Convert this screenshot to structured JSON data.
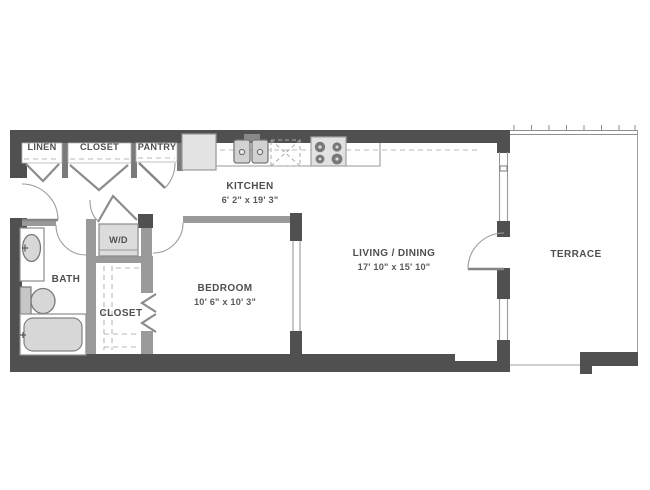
{
  "plan": {
    "type": "apartment-floor-plan",
    "rooms": {
      "linen": {
        "label": "LINEN"
      },
      "closet_hall": {
        "label": "CLOSET"
      },
      "pantry": {
        "label": "PANTRY"
      },
      "kitchen": {
        "label": "KITCHEN",
        "dimensions": "6' 2\" x 19' 3\""
      },
      "washer_dryer": {
        "label": "W/D"
      },
      "bath": {
        "label": "BATH"
      },
      "closet_bedroom": {
        "label": "CLOSET"
      },
      "bedroom": {
        "label": "BEDROOM",
        "dimensions": "10' 6\" x 10' 3\""
      },
      "living_dining": {
        "label": "LIVING / DINING",
        "dimensions": "17' 10\" x 15' 10\""
      },
      "terrace": {
        "label": "TERRACE"
      }
    },
    "colors": {
      "wall_exterior": "#505050",
      "wall_interior": "#9a9a9a",
      "fixture_fill": "#d7d7d7",
      "label_text": "#4f4f4f"
    }
  }
}
